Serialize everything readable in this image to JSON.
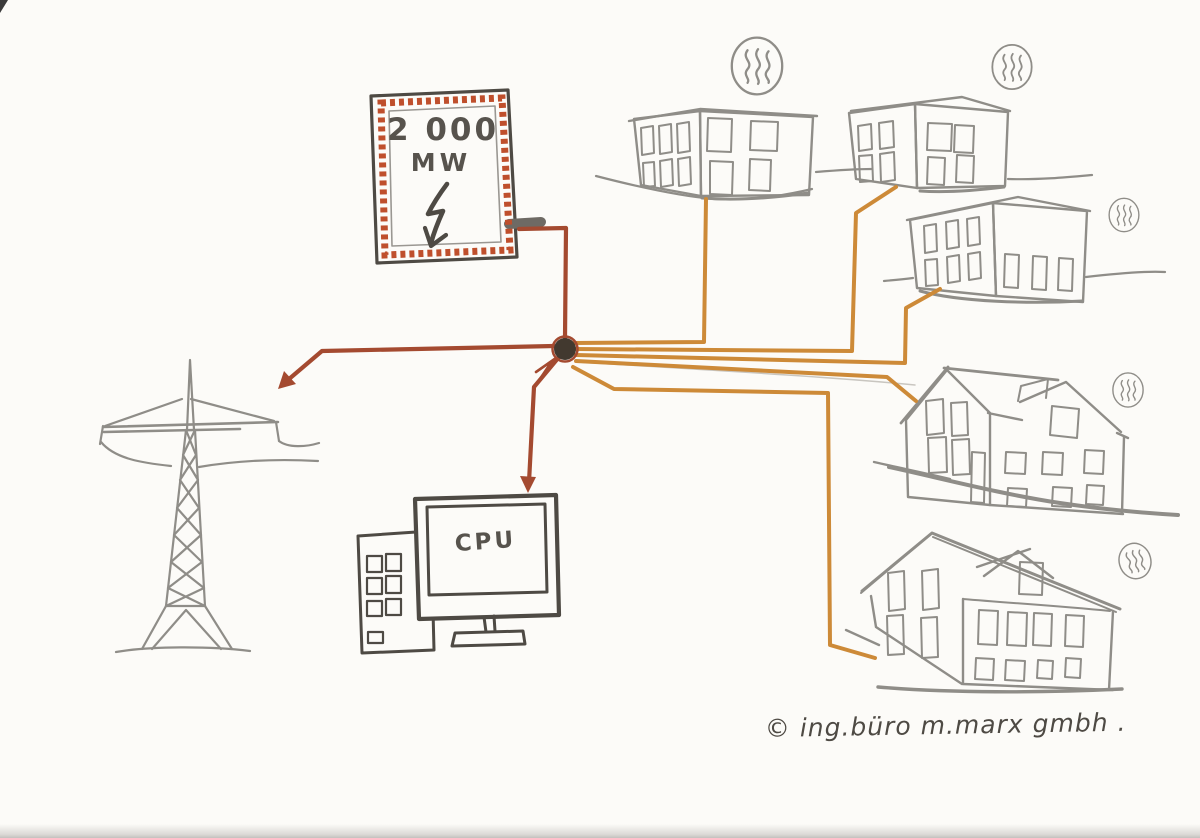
{
  "labels": {
    "plant_capacity": "2 000",
    "plant_unit": "MW",
    "cpu": "CPU",
    "signature": "© ing.büro m.marx gmbh ."
  },
  "icons": {
    "plant": "lightning-arrow-icon",
    "building_heat": "heat-waves-icon",
    "heat_icon_count": 5,
    "building_count": 5
  },
  "colors": {
    "paper": "#fcfbf8",
    "pencil_gray": "#8f8d88",
    "pencil_light": "#c9c6c0",
    "pencil_dark": "#57534d",
    "ink_dark": "#4e4a44",
    "electricity_red": "#a44a30",
    "plant_border_red": "#bf4f2c",
    "heat_orange": "#cd8a38",
    "node_fill": "#42392f"
  }
}
